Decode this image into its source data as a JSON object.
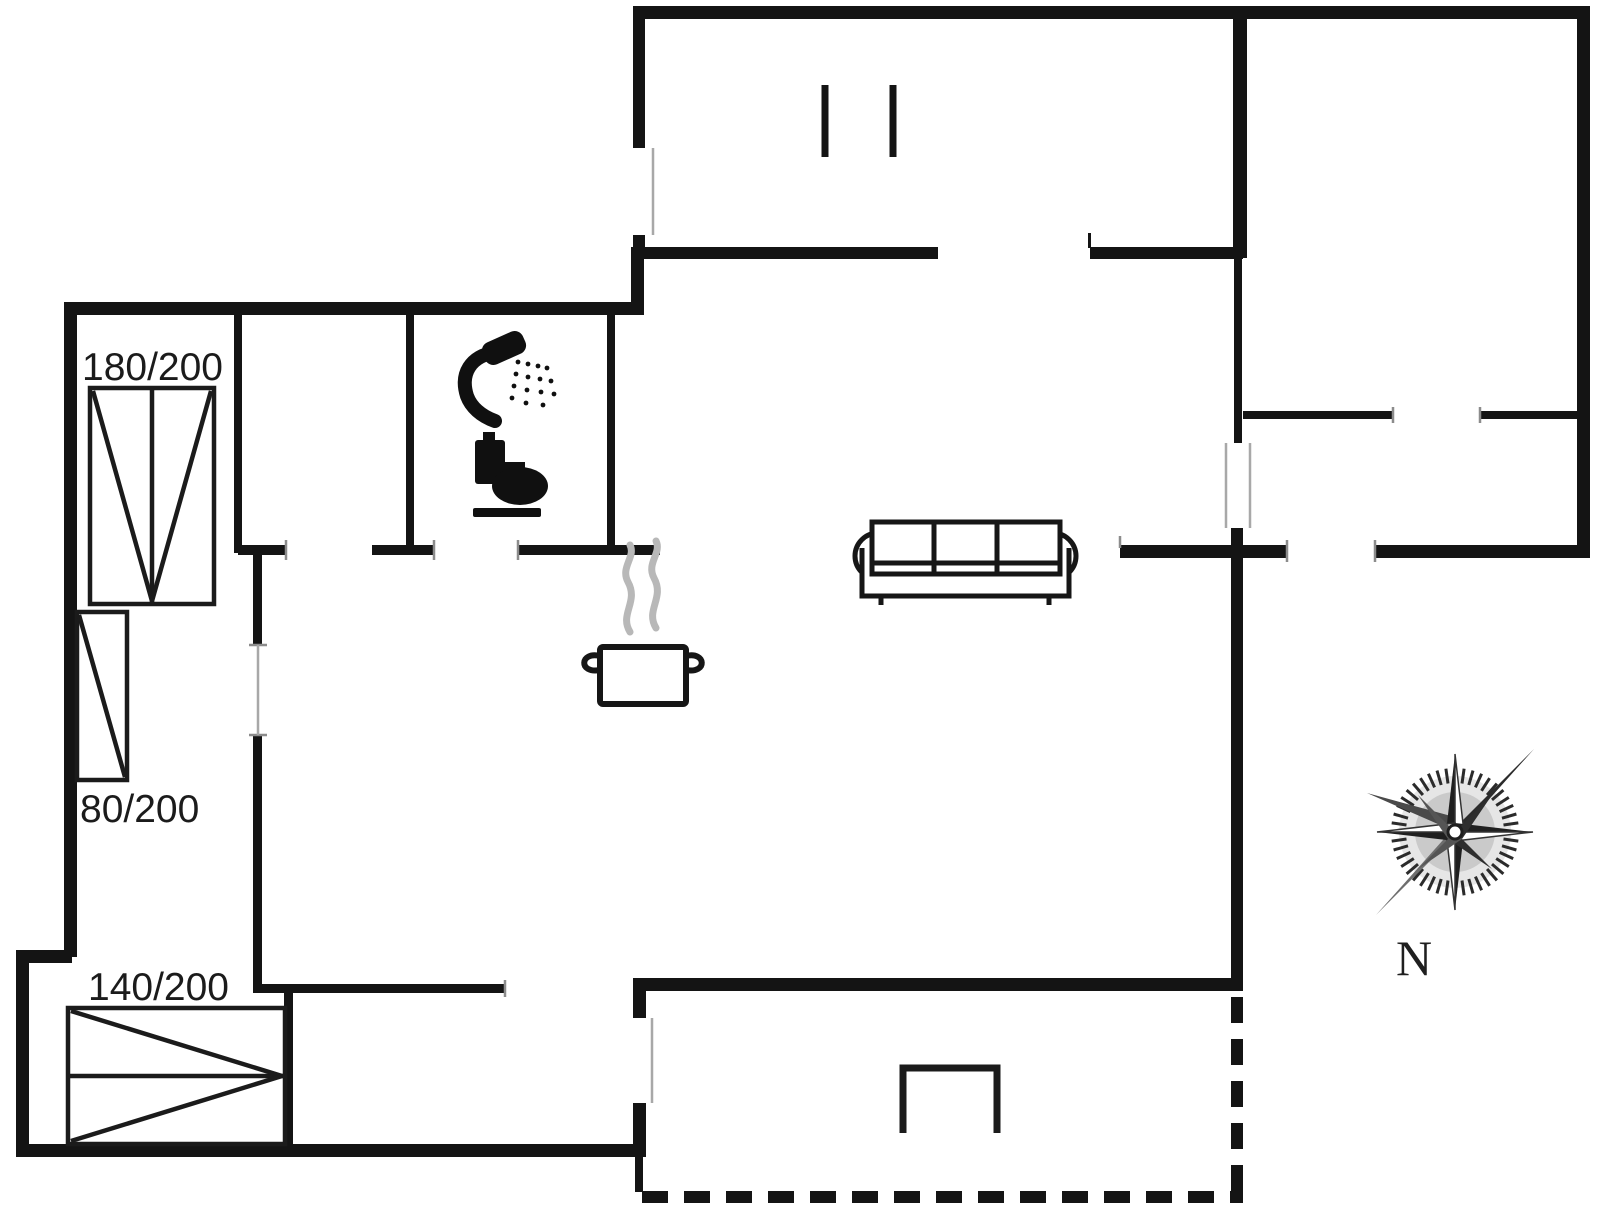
{
  "plan": {
    "background": "#ffffff",
    "wall_color": "#141414",
    "labels": {
      "bed_180": "180/200",
      "bed_80": "80/200",
      "bed_140": "140/200",
      "north": "N"
    },
    "fixtures": [
      "double-bed",
      "single-bed",
      "double-bed-140",
      "shower",
      "toilet",
      "cooking-pot",
      "sofa",
      "wardrobe",
      "terrace-step",
      "compass-rose"
    ],
    "colors": {
      "steam": "#b8b8b8",
      "window_line": "#a8a8a8",
      "door_jamb": "#8c8c8c",
      "compass": "#2b2b2b"
    }
  }
}
